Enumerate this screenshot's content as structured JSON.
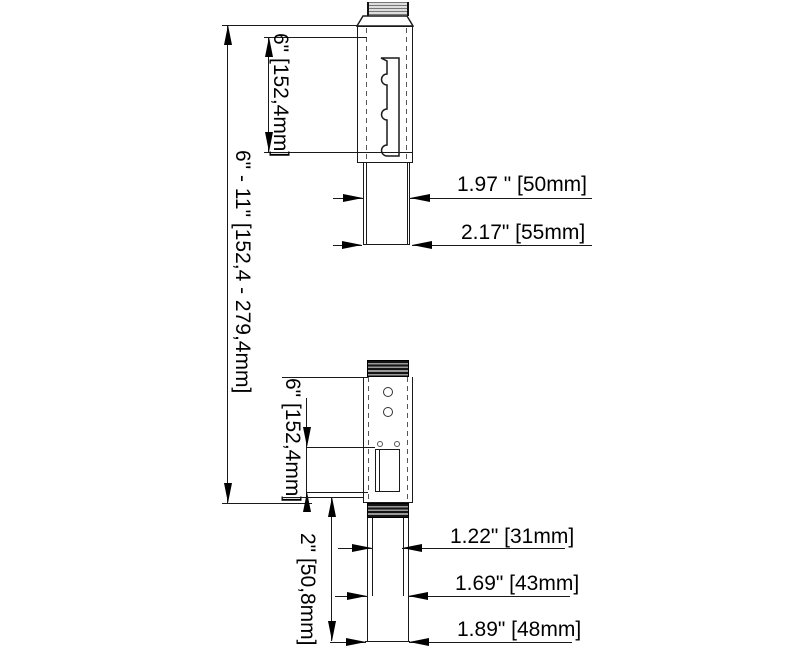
{
  "upper": {
    "dim_range": "6\" - 11\" [152,4 - 279,4mm]",
    "dim_length": "6\" [152,4mm]",
    "dim_width_inner": "1.97 \" [50mm]",
    "dim_width_outer": "2.17\" [55mm]"
  },
  "lower": {
    "dim_length": "6\" [152,4mm]",
    "dim_bottom": "2\" [50,8mm]",
    "dim_width_top": "1.22\" [31mm]",
    "dim_width_mid": "1.69\" [43mm]",
    "dim_width_bottom": "1.89\" [48mm]"
  },
  "colors": {
    "line": "#1a1a1a",
    "arrow": "#000000",
    "background": "#ffffff"
  }
}
